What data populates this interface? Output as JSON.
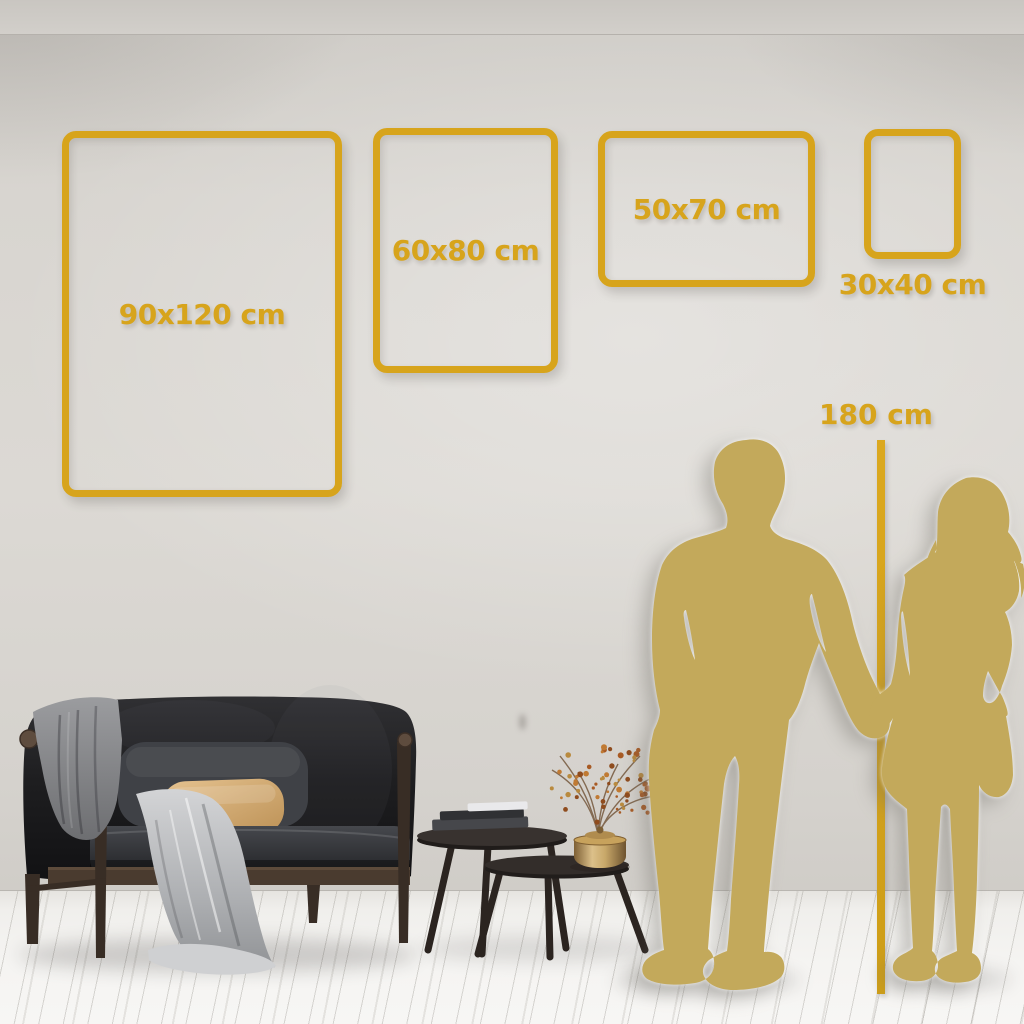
{
  "frames": [
    {
      "id": "frame-90x120",
      "label": "90x120 cm",
      "width_cm": 90,
      "height_cm": 120,
      "label_position": "inside"
    },
    {
      "id": "frame-60x80",
      "label": "60x80 cm",
      "width_cm": 60,
      "height_cm": 80,
      "label_position": "inside"
    },
    {
      "id": "frame-50x70",
      "label": "50x70 cm",
      "width_cm": 50,
      "height_cm": 70,
      "label_position": "inside"
    },
    {
      "id": "frame-30x40",
      "label": "30x40 cm",
      "width_cm": 30,
      "height_cm": 40,
      "label_position": "below"
    }
  ],
  "height_marker": {
    "label": "180 cm",
    "height_cm": 180
  },
  "colors": {
    "accent_gold": "#D7A41C",
    "silhouette_gold": "#C3A95B",
    "wall": "#D6D3CE",
    "floor": "#F2F1EE"
  },
  "scene_objects": {
    "sofa": "dark velvet loveseat with wood frame",
    "blanket_left": "gray throw over armrest",
    "blanket_front": "light throw cascading to floor",
    "pillow": "beige lumbar pillow",
    "tables": "nested round coffee tables with books",
    "vase": "brass canister vase with dried branch",
    "silhouettes": "couple holding hands"
  }
}
